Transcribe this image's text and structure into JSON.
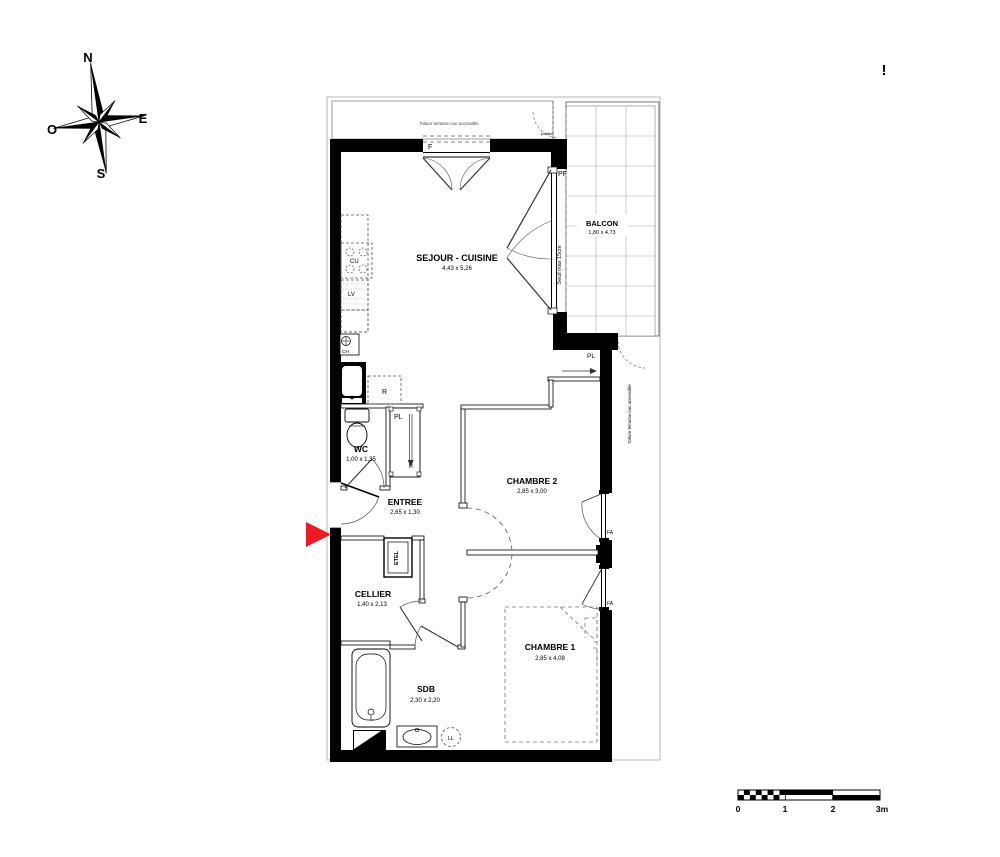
{
  "compass": {
    "n": "N",
    "e": "E",
    "s": "S",
    "o": "O"
  },
  "rooms": {
    "sejour": {
      "name": "SEJOUR - CUISINE",
      "dims": "4,43 x 5,26"
    },
    "balcon": {
      "name": "BALCON",
      "dims": "1,80 x 4,73"
    },
    "wc": {
      "name": "WC",
      "dims": "1,00 x 1,35"
    },
    "entree": {
      "name": "ENTREE",
      "dims": "2,65 x 1,30"
    },
    "cellier": {
      "name": "CELLIER",
      "dims": "1,40 x 2,13"
    },
    "chambre2": {
      "name": "CHAMBRE 2",
      "dims": "2,85 x 3,00"
    },
    "chambre1": {
      "name": "CHAMBRE 1",
      "dims": "2,85 x 4,08"
    },
    "sdb": {
      "name": "SDB",
      "dims": "2,30 x 2,20"
    }
  },
  "labels": {
    "window_f": "F",
    "door_pf": "PF",
    "seuil": "Seuil max 15cm",
    "closet_sejour": "PL",
    "closet_entree": "PL",
    "fridge": "R",
    "etel": "ETEL",
    "cooktop": "CU",
    "dishwasher": "LV",
    "heater": "CH",
    "washing_machine": "LL",
    "window_fa_ch2": "FA",
    "window_fa_ch1": "FA",
    "terrace_top": "Toiture terrasse non accessible",
    "terrace_side": "Toiture terrasse non accessible",
    "gate": "portillon",
    "alert": "!"
  },
  "scale_bar": {
    "ticks": [
      "0",
      "1",
      "2",
      "3m"
    ]
  },
  "colors": {
    "arrow_red": "#ed1c24",
    "wall": "#000000",
    "alert_red": "#e8312e"
  }
}
